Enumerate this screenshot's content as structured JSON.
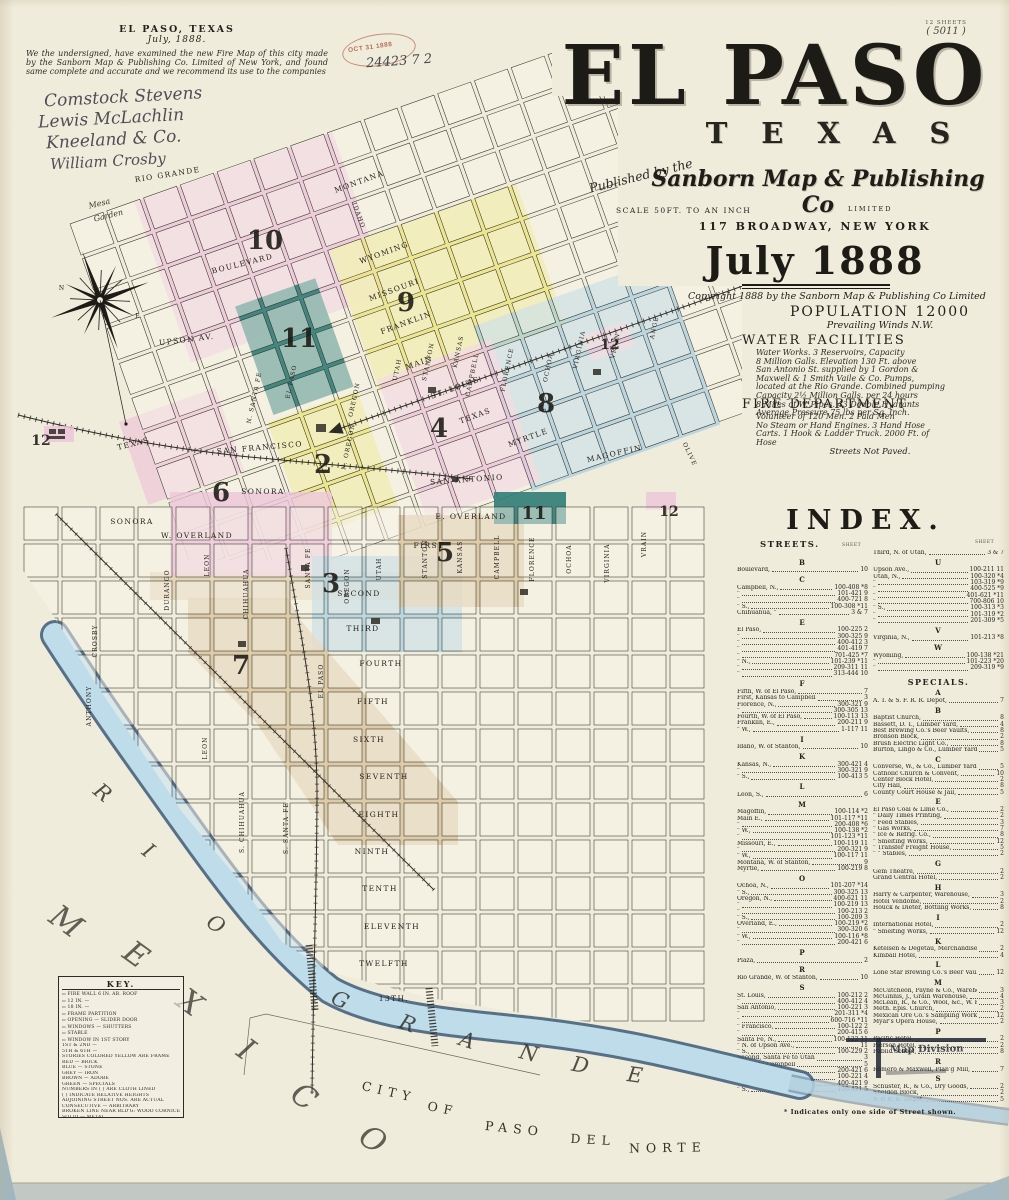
{
  "palette": {
    "pink": "#edc6d9",
    "yellow": "#ece584",
    "teal": "#337f7a",
    "blue": "#aacfdf",
    "tan": "#d8c29a",
    "pink_lt": "#f2d6e3",
    "river_blue": "#bfdcea",
    "river_edge": "#3d5a78",
    "ink": "#22211c",
    "stamp_red": "#bb6d59",
    "paper": "#f0ecdb"
  },
  "page": {
    "sheets_note": "12 SHEETS",
    "sheet_no": "( 5011 )"
  },
  "attestation": {
    "place": "EL PASO, TEXAS",
    "date": "July, 1888.",
    "body": "We the undersigned, have examined the new Fire Map of this city made by the Sanborn Map & Publishing Co. Limited of New York, and found same complete and accurate and we recommend its use to the companies",
    "signatures": [
      "Comstock Stevens",
      "Lewis McLachlin",
      "Kneeland & Co.",
      "William Crosby"
    ]
  },
  "stamp": {
    "date": "OCT 31 1888",
    "number": "24423 7 2"
  },
  "title": {
    "city": "EL PASO",
    "state": "TEXAS",
    "published_by": "Published by the",
    "publisher": "Sanborn Map & Publishing Co",
    "limited": "LIMITED",
    "scale": "SCALE 50FT. TO AN INCH",
    "address": "117 BROADWAY, NEW YORK",
    "date": "July 1888",
    "copyright": "Copyright 1888 by the Sanborn Map & Publishing Co Limited"
  },
  "info": {
    "population": "POPULATION 12000",
    "winds": "Prevailing Winds N.W.",
    "water_heading": "WATER FACILITIES",
    "water_lines": [
      "Water Works.  3 Reservoirs, Capacity",
      "8 Million Galls.  Elevation 130 Ft. above",
      "San Antonio St. supplied by 1 Gordon &",
      "Maxwell & 1 Smith Vaile & Co. Pumps,",
      "located at the Rio Grande.  Combined pumping",
      "Capacity 2½ Million Galls. per 24 hours",
      "8 Miles of W. Pipes.  43 Double Hydrants",
      "Average Pressure  75 lbs per Sq. Inch."
    ],
    "fire_heading": "FIRE DEPARTMENT",
    "fire_lines": [
      "Volunteer of 120 Men.  2 Paid Men",
      "No Steam or Hand Engines.  3 Hand Hose",
      "Carts.  1 Hook & Ladder Truck.  2000 Ft. of",
      "Hose"
    ],
    "paved": "Streets Not Paved."
  },
  "index": {
    "heading": "INDEX.",
    "streets_heading": "STREETS.",
    "sheet_label": "SHEET",
    "specials_heading": "SPECIALS.",
    "footnote": "* Indicates only one side of Street shown.",
    "streets_left": [
      {
        "letter": "B",
        "rows": [
          [
            "Boulevard,",
            "10"
          ]
        ]
      },
      {
        "letter": "C",
        "rows": [
          [
            "Campbell, N.,",
            "100-408 *8"
          ],
          [
            "\"",
            "101-421 9"
          ],
          [
            "\"",
            "400-721 8"
          ],
          [
            "\"  S.,",
            "100-308 *11"
          ],
          [
            "Chihuahua, \"",
            "3 & 7"
          ]
        ]
      },
      {
        "letter": "E",
        "rows": [
          [
            "El Paso,",
            "100-225 2"
          ],
          [
            "\"",
            "300-325 9"
          ],
          [
            "\"",
            "400-412 3"
          ],
          [
            "\"",
            "401-419 7"
          ],
          [
            "\"",
            "701-425 *7"
          ],
          [
            "\"  N.,",
            "101-239 *11"
          ],
          [
            "\"",
            "209-311 11"
          ],
          [
            "\"",
            "313-444 10"
          ]
        ]
      },
      {
        "letter": "F",
        "rows": [
          [
            "Fifth, W. of El Paso,",
            "7"
          ],
          [
            "First,  Kansas to Campbell",
            "3"
          ],
          [
            "Florence, N.,",
            "300-321 9"
          ],
          [
            "\"",
            "300-305 13"
          ],
          [
            "Fourth, W. of El Paso,",
            "100-113 13"
          ],
          [
            "Franklin, E.,",
            "200-211 9"
          ],
          [
            "\"  W.,",
            "1-117 11"
          ]
        ]
      },
      {
        "letter": "I",
        "rows": [
          [
            "Idaho, W. of Stanton,",
            "10"
          ]
        ]
      },
      {
        "letter": "K",
        "rows": [
          [
            "Kansas, N.,",
            "300-421 4"
          ],
          [
            "\"",
            "300-321 9"
          ],
          [
            "\"  S.,",
            "100-413 5"
          ]
        ]
      },
      {
        "letter": "L",
        "rows": [
          [
            "Leon, S.,",
            "6"
          ]
        ]
      },
      {
        "letter": "M",
        "rows": [
          [
            "Magoffin,",
            "100-114 *2"
          ],
          [
            "Main E.,",
            "101-117 *11"
          ],
          [
            "\"",
            "200-408 *6"
          ],
          [
            "\"  W.,",
            "100-138 *2"
          ],
          [
            "\"",
            "101-123 *11"
          ],
          [
            "Missouri, E.,",
            "100-119 11"
          ],
          [
            "\"",
            "200-321 9"
          ],
          [
            "\"  W.,",
            "100-117 11"
          ],
          [
            "Montana, W. of Stanton,",
            "9"
          ],
          [
            "Myrtle,",
            "100-219 8"
          ]
        ]
      },
      {
        "letter": "O",
        "rows": [
          [
            "Ochoa, N.,",
            "101-207 *14"
          ],
          [
            "\"  S.,",
            "300-325 13"
          ],
          [
            "Oregon, N.,",
            "400-621 11"
          ],
          [
            "\"",
            "100-219 13"
          ],
          [
            "\"",
            "100-213 2"
          ],
          [
            "\"  S.,",
            "100-209 3"
          ],
          [
            "Overland, E.,",
            "100-219 *2"
          ],
          [
            "\"",
            "300-320 6"
          ],
          [
            "\"  W.,",
            "100-116 *8"
          ],
          [
            "\"",
            "200-421 6"
          ]
        ]
      },
      {
        "letter": "P",
        "rows": [
          [
            "Plaza,",
            "2"
          ]
        ]
      },
      {
        "letter": "R",
        "rows": [
          [
            "Rio Grande, W. of Stanton,",
            "10"
          ]
        ]
      },
      {
        "letter": "S",
        "rows": [
          [
            "St. Louis,",
            "100-212 2"
          ],
          [
            "\"",
            "400-412 4"
          ],
          [
            "San Antonio,",
            "100-221 3"
          ],
          [
            "\"",
            "201-311 *4"
          ],
          [
            "\"",
            "600-716 *11"
          ],
          [
            "\"  Francisco,",
            "100-122 2"
          ],
          [
            "\"",
            "200-415 6"
          ],
          [
            "Santa Fe, N.,",
            "100-122 11"
          ],
          [
            "\"  N. of Upson Ave.,",
            "11"
          ],
          [
            "\"  S.,",
            "100-229 2"
          ],
          [
            "Second,  Santa Fe to Utah",
            "3"
          ],
          [
            "\"  Utah to Campbell",
            "5"
          ],
          [
            "Sonora,",
            "200-421 6"
          ],
          [
            "Stanton, N.,",
            "100-221 4"
          ],
          [
            "\"",
            "400-421 9"
          ],
          [
            "\"  S.,",
            "100-421 5"
          ]
        ]
      },
      {
        "letter": "T",
        "rows": [
          [
            "Texas,",
            "100-120 2"
          ],
          [
            "\"",
            "200-405 4"
          ],
          [
            "\"",
            "300-730 8"
          ]
        ]
      }
    ],
    "streets_right": [
      {
        "letter": "",
        "rows": [
          [
            "Third, N. of Utah,",
            "3 & 7"
          ]
        ]
      },
      {
        "letter": "U",
        "rows": [
          [
            "Upson Ave.,",
            "100-211 11"
          ],
          [
            "Utah, N.,",
            "100-320 *4"
          ],
          [
            "\"",
            "103-319 *9"
          ],
          [
            "\"",
            "400-525 *9"
          ],
          [
            "\"",
            "401-621 *11"
          ],
          [
            "\"",
            "700-806 10"
          ],
          [
            "\"  S.,",
            "100-313 *3"
          ],
          [
            "\"",
            "101-319 *2"
          ],
          [
            "\"",
            "201-309 *5"
          ]
        ]
      },
      {
        "letter": "V",
        "rows": [
          [
            "Virginia, N.,",
            "101-213 *8"
          ]
        ]
      },
      {
        "letter": "W",
        "rows": [
          [
            "Wyoming,",
            "100-138 *21"
          ],
          [
            "\"",
            "101-223 *20"
          ],
          [
            "\"",
            "209-319 *9"
          ]
        ]
      }
    ],
    "specials": [
      {
        "letter": "A",
        "rows": [
          [
            "A. T. & S. F. R. R. Depot,",
            "7"
          ]
        ]
      },
      {
        "letter": "B",
        "rows": [
          [
            "Baptist Church,",
            "8"
          ],
          [
            "Bassett, D. T., Lumber Yard,",
            "4"
          ],
          [
            "Best Brewing Co.'s Beer Vaults,",
            "8"
          ],
          [
            "Bronson Block,",
            "2"
          ],
          [
            "Brush Electric Light Co.,",
            "8"
          ],
          [
            "Burton, Lingo & Co., Lumber Yard,",
            "5"
          ]
        ]
      },
      {
        "letter": "C",
        "rows": [
          [
            "Converse, W., & Co., Lumber Yard,",
            "5"
          ],
          [
            "Catholic Church & Convent,",
            "10"
          ],
          [
            "Center Block Hotel,",
            "2"
          ],
          [
            "City Hall,",
            "8"
          ],
          [
            "County Court House & Jail,",
            "5"
          ]
        ]
      },
      {
        "letter": "E",
        "rows": [
          [
            "El Paso Coal & Lime Co.,",
            "2"
          ],
          [
            "\"  Daily Times Printing,",
            "2"
          ],
          [
            "\"  Feed Stables,",
            "3"
          ],
          [
            "\"  Gas Works,",
            "7"
          ],
          [
            "\"  Ice & Refrig. Co.,",
            "8"
          ],
          [
            "\"  Smelting Works,",
            "12"
          ],
          [
            "\"  Transfer Freight House,",
            "5"
          ],
          [
            "\"  \"  Stables,",
            "2"
          ]
        ]
      },
      {
        "letter": "G",
        "rows": [
          [
            "Gem Theatre,",
            "2"
          ],
          [
            "Grand Central Hotel,",
            "2"
          ]
        ]
      },
      {
        "letter": "H",
        "rows": [
          [
            "Harry & Carpenter, Warehouse,",
            "3"
          ],
          [
            "Hotel Vendome,",
            "2"
          ],
          [
            "Houck & Dieter, Bottling Works,",
            "8"
          ]
        ]
      },
      {
        "letter": "I",
        "rows": [
          [
            "International Hotel,",
            "2"
          ],
          [
            "\"  Smelting Works,",
            "12"
          ]
        ]
      },
      {
        "letter": "K",
        "rows": [
          [
            "Ketelsen & Degetau, Merchandise,",
            "2"
          ],
          [
            "Kimball Hotel,",
            "4"
          ]
        ]
      },
      {
        "letter": "L",
        "rows": [
          [
            "Lone Star Brewing Co.'s Beer Vault,",
            "12"
          ]
        ]
      },
      {
        "letter": "M",
        "rows": [
          [
            "McCutcheon, Payne & Co., Warehouse,",
            "3"
          ],
          [
            "McGinnis, J., Grain Warehouse,",
            "4"
          ],
          [
            "McLean, R., & Co., Wool, &c., W. H.,",
            "3"
          ],
          [
            "Meth. Epis. Church,",
            "2"
          ],
          [
            "Mexican Ore Co.'s Sampling Works,",
            "12"
          ],
          [
            "Myar's Opera House,",
            "2"
          ]
        ]
      },
      {
        "letter": "P",
        "rows": [
          [
            "Pacific Hotel,",
            "2"
          ],
          [
            "Pierson Hotel,",
            "2"
          ],
          [
            "Public School,",
            "8"
          ]
        ]
      },
      {
        "letter": "R",
        "rows": [
          [
            "Romero & Maxwell, Plan'g Mill,",
            "7"
          ]
        ]
      },
      {
        "letter": "S",
        "rows": [
          [
            "Schuster, R., & Co., Dry Goods,",
            "2"
          ],
          [
            "Sheldon Block,",
            "2"
          ],
          [
            "S. P. R. R. Depot,",
            "5"
          ],
          [
            "Star Livery,",
            "3"
          ],
          [
            "State National Bank Building,",
            "2"
          ],
          [
            "Stuart & McNair, Warehouse,",
            "4"
          ]
        ]
      },
      {
        "letter": "U",
        "rows": [
          [
            "Union Bakery,",
            "3"
          ],
          [
            "U. S. Custom House,",
            "2"
          ]
        ]
      },
      {
        "letter": "W",
        "rows": [
          [
            "Water Pierce Oil Co.,",
            "7"
          ]
        ]
      }
    ]
  },
  "map_division_stamp": "Map Division",
  "key": {
    "title": "KEY.",
    "rows": [
      "FIRE WALL 6 IN. AB. ROOF",
      "12 IN. —",
      "18 IN. —",
      "FRAME PARTITION",
      "OPENING — SLIDER DOOR",
      "WINDOWS — SHUTTERS",
      "STABLE",
      "WINDOW IN 1ST STORY",
      "1ST & 2ND —",
      "5TH & 6TH —",
      "STORIES COLORED YELLOW ARE FRAME",
      "RED — BRICK",
      "BLUE — STONE",
      "GREY — IRON",
      "BROWN — ADOBE",
      "GREEN — SPECIALS",
      "NUMBERS IN ( ) ARE CLOTH LINED",
      "( ) INDICATE RELATIVE HEIGHTS",
      "ADJOINING STREET NOS. ARE ACTUAL",
      "CONSECUTIVE — ARBITRARY",
      "BROKEN LINE NEAR BLD'G: WOOD CORNICE",
      "SOLID — METAL"
    ]
  },
  "map": {
    "labels": {
      "rio_grande_st": "RIO GRANDE",
      "montana": "MONTANA",
      "idaho": "IDAHO",
      "wyoming": "WYOMING",
      "missouri": "MISSOURI",
      "franklin": "FRANKLIN",
      "boulevard": "BOULEVARD",
      "upson": "UPSON AV.",
      "main": "MAIN",
      "st_louis": "ST. LOUIS",
      "texas_st": "TEXAS",
      "texas2": "TEXAS",
      "san_francisco": "SAN FRANCISCO",
      "san_antonio": "SAN ANTONIO",
      "myrtle": "MYRTLE",
      "magoffin": "MAGOFFIN",
      "olive": "OLIVE",
      "mesa": "Mesa",
      "garden": "Garden",
      "santa_fe_n": "N. SANTA FE",
      "el_paso_v": "EL PASO",
      "oregon_v": "OREGON",
      "utah_v": "UTAH",
      "stanton_v": "STANTON",
      "kansas_v": "KANSAS",
      "campbell_v": "CAMPBELL",
      "florence_v": "FLORENCE",
      "ochoa_v": "OCHOA",
      "virginia_v": "VIRGINIA",
      "vrain_v": "VRAIN",
      "ange_v": "ANGE",
      "oregon2_v": "N. OREGON",
      "sonora": "SONORA",
      "sonora2": "SONORA",
      "overland_w": "W.  OVERLAND",
      "overland_e": "E.  OVERLAND",
      "first": "FIRST",
      "second": "SECOND",
      "third": "THIRD",
      "fourth": "FOURTH",
      "fifth": "FIFTH",
      "sixth": "SIXTH",
      "seventh": "SEVENTH",
      "eighth": "EIGHTH",
      "ninth": "NINTH",
      "tenth": "TENTH",
      "eleventh": "ELEVENTH",
      "twelfth": "TWELFTH",
      "thirteenth": "13TH.",
      "anthony": "ANTHONY",
      "crosby": "CROSBY",
      "durango": "DURANGO",
      "leon": "LEON",
      "leon2": "LEON",
      "chihuahua": "CHIHUAHUA",
      "chihuahua2": "S. CHIHUAHUA",
      "santa_fe_s": "SANTA FE",
      "santa_fe_s2": "S. SANTA FE",
      "el_paso_s": "EL PASO",
      "oregon_s": "OREGON",
      "utah_s": "UTAH",
      "stanton_s": "STANTON",
      "kansas_s": "KANSAS",
      "campbell_s": "CAMPBELL",
      "florence_s": "FLORENCE",
      "ochoa_s": "OCHOA",
      "virginia_s": "VIRGINIA",
      "vrain_s": "VRAIN",
      "city": "CITY",
      "of": "OF",
      "paso": "PASO",
      "del": "DEL",
      "norte": "NORTE"
    },
    "compass": {
      "n": "N",
      "e": "E"
    },
    "river_letters": [
      "R",
      "I",
      "O",
      "G",
      "R",
      "A",
      "N",
      "D",
      "E"
    ],
    "mexico_letters": [
      "M",
      "E",
      "X",
      "I",
      "C",
      "O"
    ],
    "districts": {
      "d10": "10",
      "d9": "9",
      "d11a": "11",
      "d8": "8",
      "d4": "4",
      "d2": "2",
      "d6": "6",
      "d5": "5",
      "d3": "3",
      "d7": "7",
      "d12a": "12",
      "d11b": "11",
      "d12b": "12",
      "d12c": "12"
    }
  }
}
